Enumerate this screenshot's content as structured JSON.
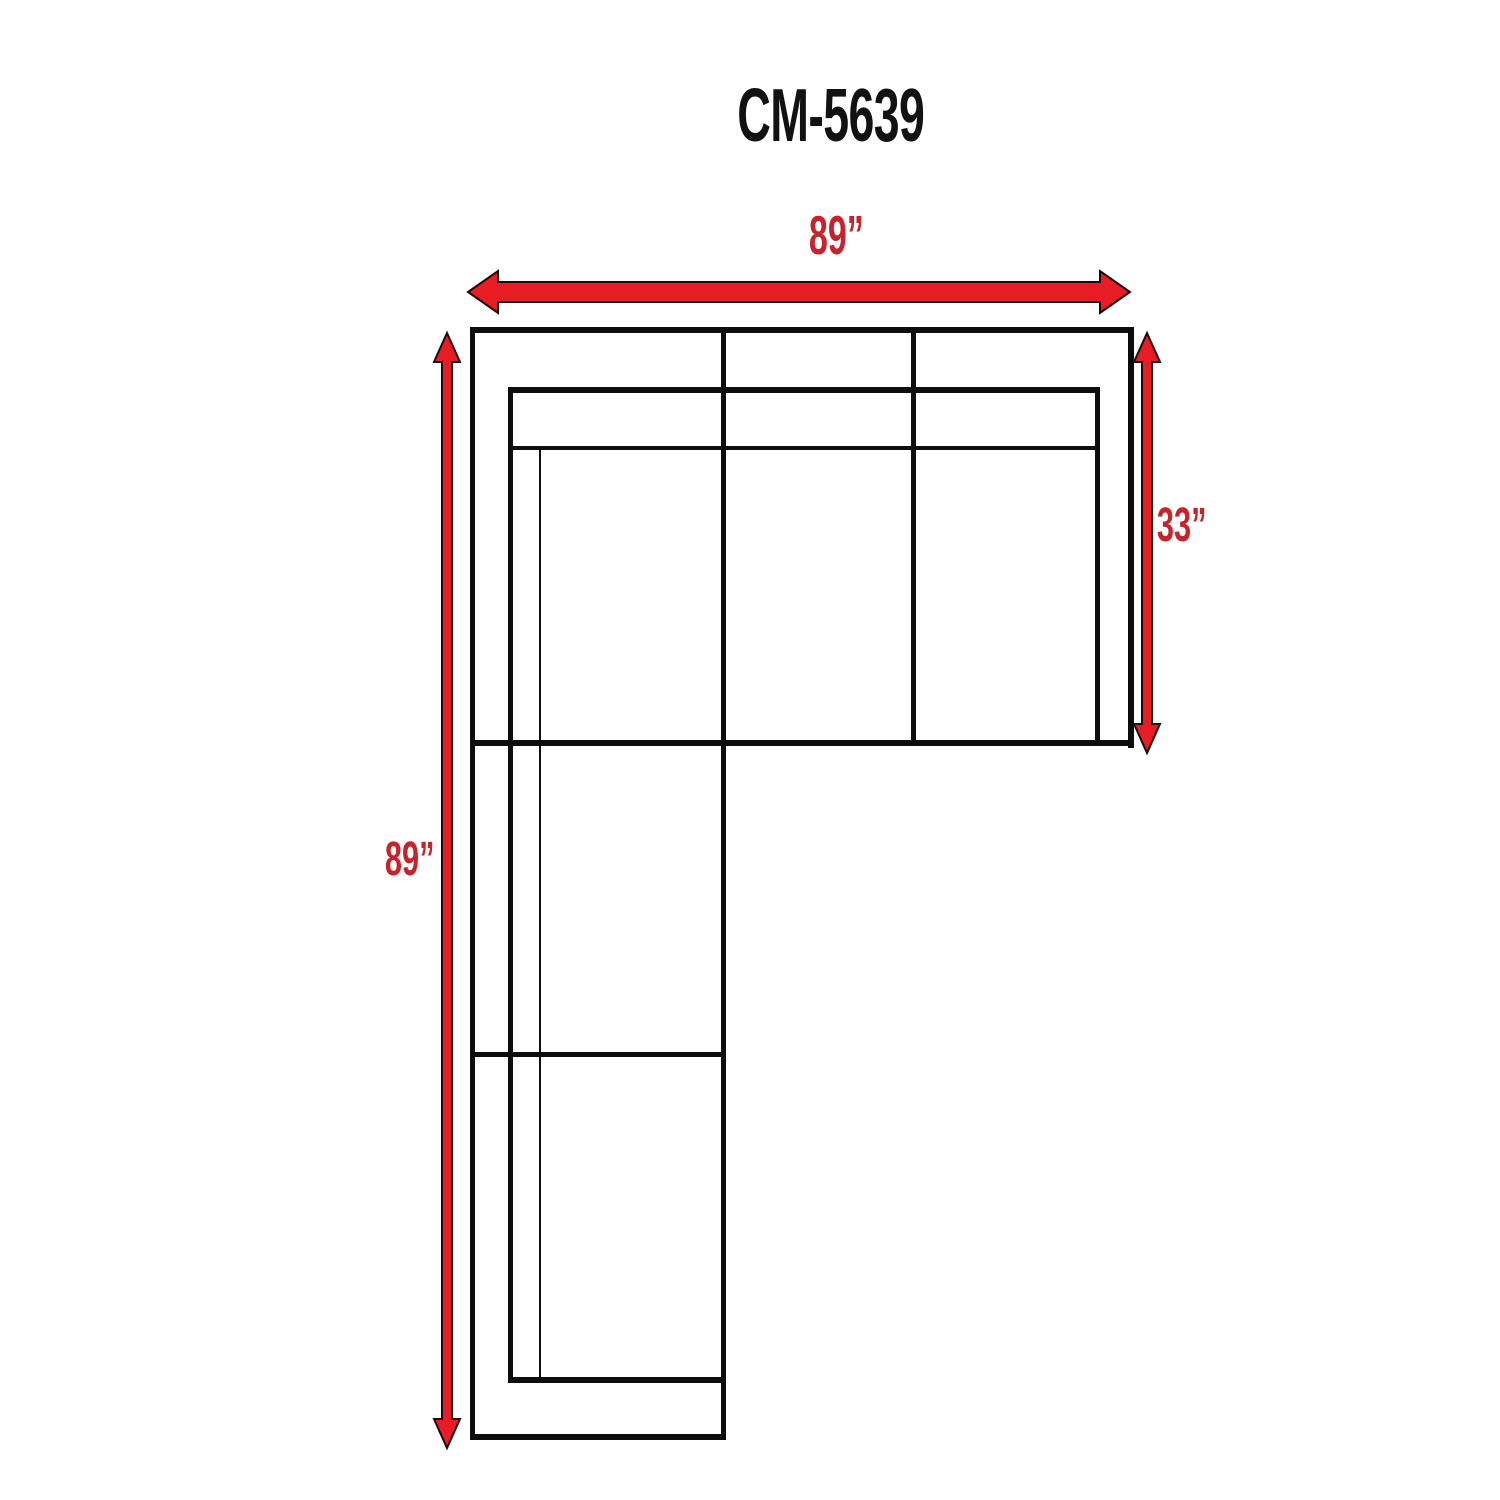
{
  "title": "CM-5639",
  "dimensions": {
    "width_top": "89”",
    "depth_right": "33”",
    "height_left": "89”"
  },
  "icons": {
    "top_arrow": "horizontal-double-arrow",
    "right_arrow": "vertical-double-arrow",
    "left_arrow": "vertical-double-arrow"
  },
  "colors": {
    "background": "#ffffff",
    "line_black": "#0d0d0d",
    "label_red": "#c8232a",
    "arrow_fill": "#e81c24",
    "arrow_outline": "#1a0c0d"
  }
}
